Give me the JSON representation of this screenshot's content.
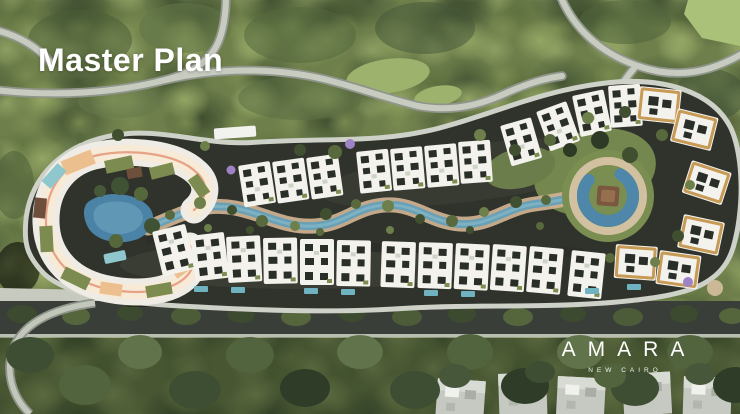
{
  "slide": {
    "title": "Master Plan",
    "brand": {
      "name": "AMARA",
      "tagline": "NEW CAIRO"
    }
  },
  "palette": {
    "foliage_base": "#6e7f4b",
    "foliage_dark": "#3e4e31",
    "foliage_light": "#93a467",
    "lawn_green": "#a9c179",
    "road_light": "#c8ccc0",
    "road_casing": "#8f958a",
    "asphalt_dark": "#30332c",
    "pavement_light": "#cdd1c7",
    "building_white": "#f3f2ed",
    "roof_detail_dark": "#2a2e29",
    "roof_gold_trim": "#c79a56",
    "clubhouse_cream": "#f7ead6",
    "clubhouse_salmon": "#e8a285",
    "clubhouse_peach": "#ecc08e",
    "roof_garden_olive": "#7c8b4f",
    "pool_teal": "#8ec7cd",
    "canal_water": "#6aa0b5",
    "lagoon_water": "#4a83a6",
    "sand_path": "#d0b292",
    "deck_brown": "#7a573e",
    "jacaranda_purple": "#9d82c6",
    "text_white": "#ffffff"
  }
}
